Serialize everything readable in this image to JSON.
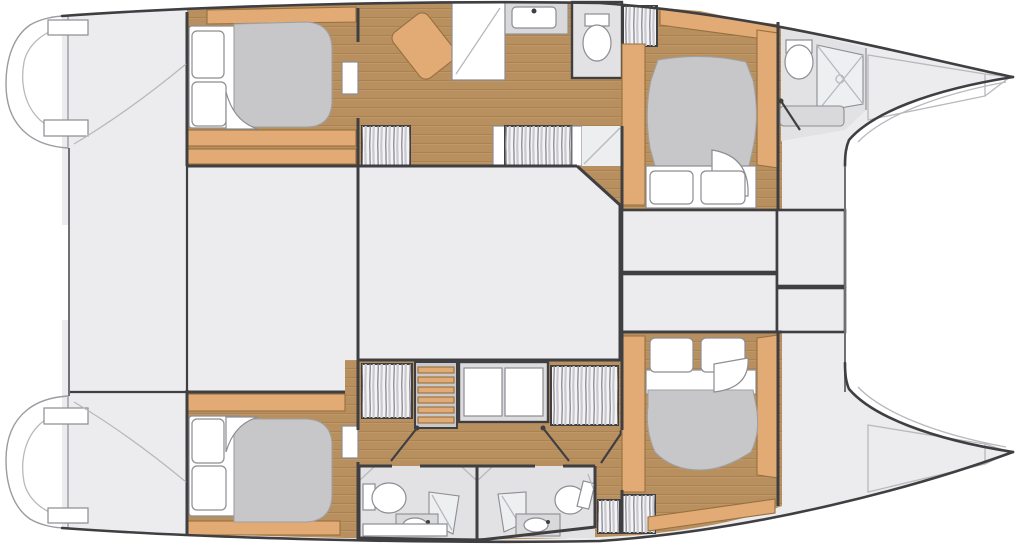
{
  "diagram": {
    "type": "catamaran-deck-plan",
    "orientation": "bows-to-the-right"
  },
  "colors": {
    "bg": "#ffffff",
    "deck": "#ececee",
    "deck_line": "#9b9ba1",
    "wall": "#3f3f42",
    "wood": "#b8905f",
    "wood_line": "#a07848",
    "wood_hi": "#caa06e",
    "accent": "#e2aa74",
    "accent_line": "#96703f",
    "mattress": "#c7c7c9",
    "mattress_line": "#9fa0a3",
    "fixture": "#ffffff",
    "fixture_line": "#8d8d92",
    "bath_floor": "#e2e2e4",
    "wardrobe": "#f4f4f6",
    "stripe_dark": "#8f8f96",
    "stripe_light": "#c9c9ce",
    "light_line": "#b9b9bd",
    "counter": "#d9d9db"
  },
  "elements": {
    "port_hull": [
      "aft-double-bed",
      "chaise-longue",
      "shower-room",
      "vanity-sink",
      "wc-room",
      "hanging-lockers",
      "companionway-stairs",
      "forward-double-bed",
      "forward-bathroom",
      "bow-deck"
    ],
    "starboard_hull": [
      "aft-double-bed",
      "hanging-lockers",
      "companionway-ladder",
      "storage-cabinet",
      "bathroom-aft",
      "bathroom-forward",
      "small-lockers",
      "forward-double-bed",
      "bow-deck"
    ],
    "amidships": [
      "bridge-deck",
      "saloon-box",
      "technical-compartments",
      "stern-platforms",
      "crossbeam"
    ]
  }
}
